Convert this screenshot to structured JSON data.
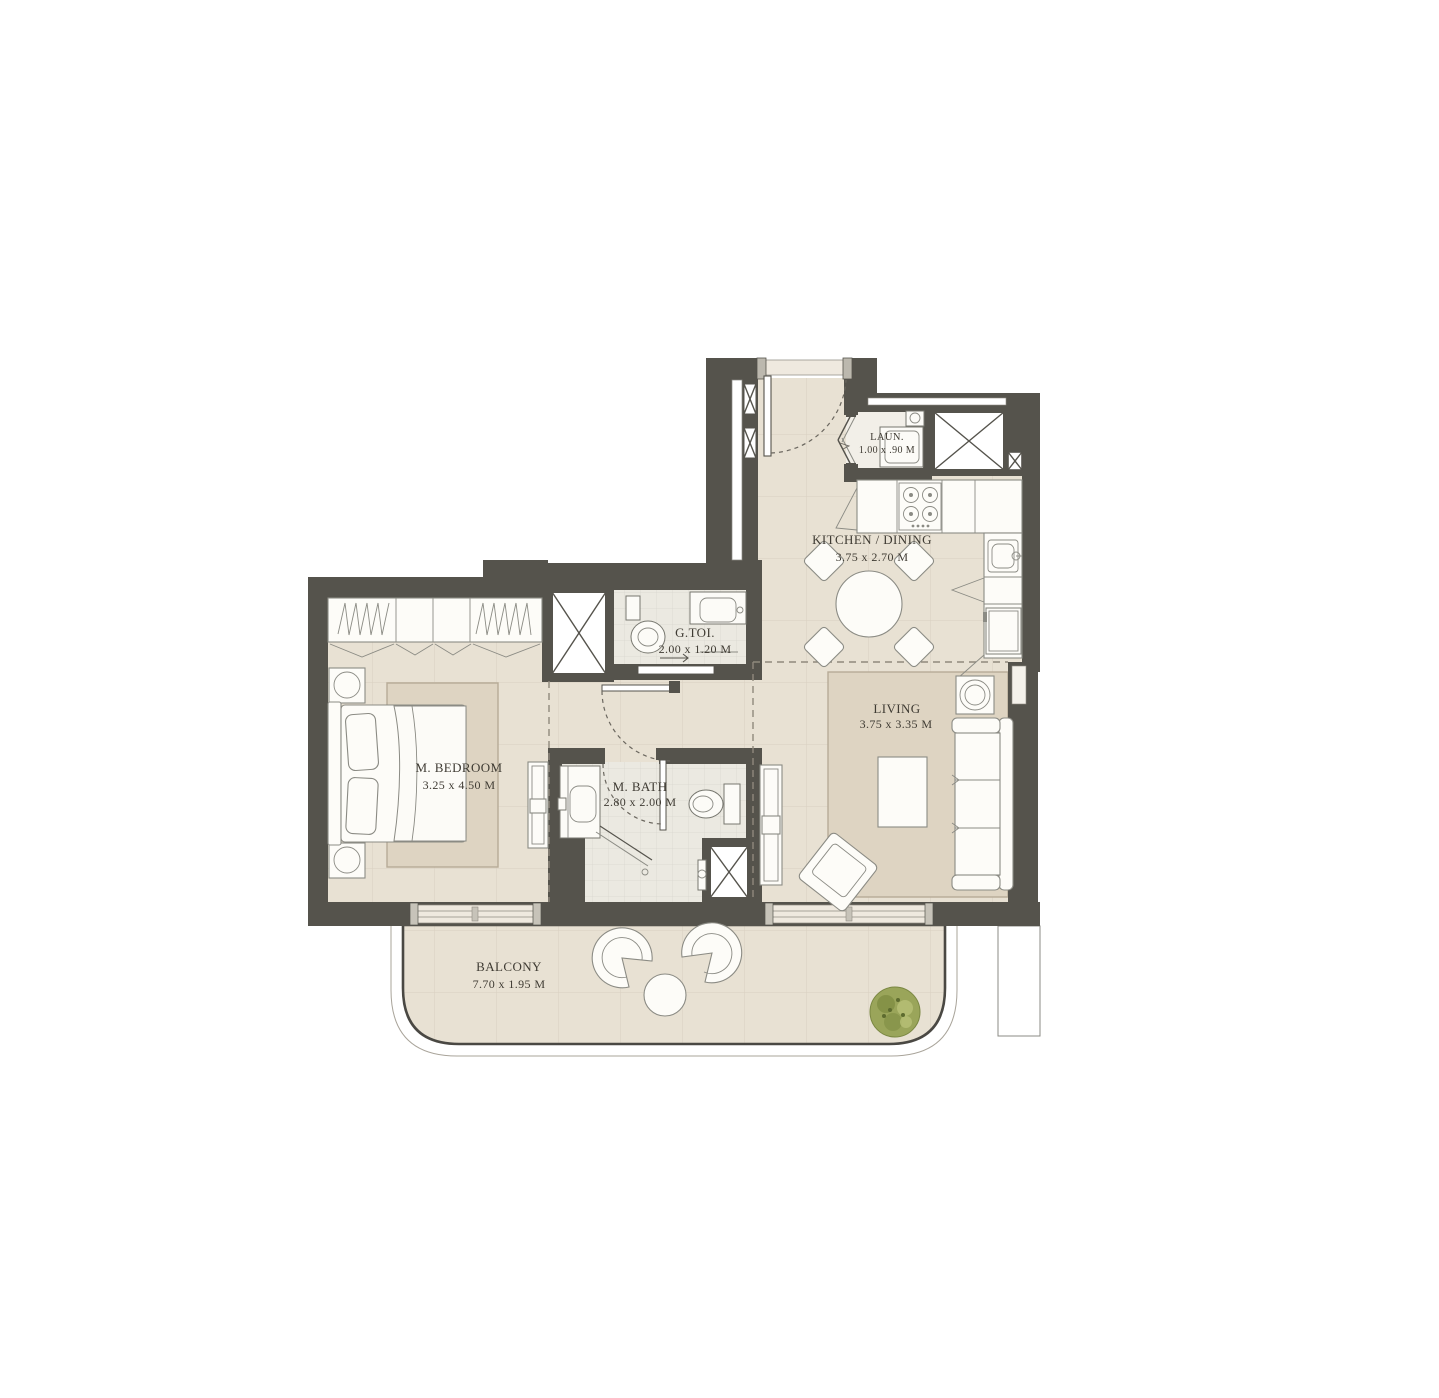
{
  "plan": {
    "rooms": {
      "bedroom": {
        "name": "M. BEDROOM",
        "dims": "3.25 x 4.50 M"
      },
      "gtoi": {
        "name": "G.TOI.",
        "dims": "2.00 x 1.20 M"
      },
      "mbath": {
        "name": "M. BATH",
        "dims": "2.80 x 2.00 M"
      },
      "kitchen": {
        "name": "KITCHEN / DINING",
        "dims": "3.75 x 2.70 M"
      },
      "living": {
        "name": "LIVING",
        "dims": "3.75 x 3.35 M"
      },
      "laundry": {
        "name": "LAUN.",
        "dims": "1.00 x .90 M"
      },
      "balcony": {
        "name": "BALCONY",
        "dims": "7.70 x 1.95 M"
      }
    },
    "colors": {
      "wall": "#55534c",
      "floor": "#e8e1d3",
      "tile_line": "#d9d0c0",
      "bath_tile": "#ebe9e1",
      "rug": "#ded4c2",
      "furniture": "#fdfcf8",
      "outline": "#8b8b84",
      "text": "#3f3b33",
      "plant": "#97a355"
    }
  }
}
